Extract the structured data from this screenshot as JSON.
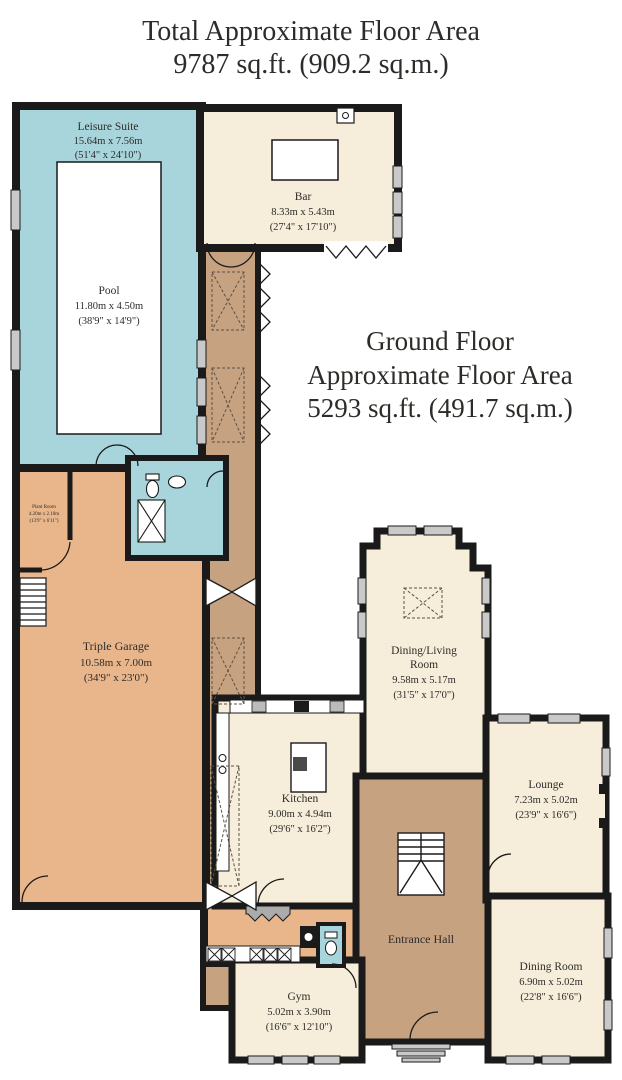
{
  "title": {
    "line1": "Total Approximate Floor Area",
    "line2": "9787 sq.ft. (909.2 sq.m.)"
  },
  "ground_floor": {
    "line1": "Ground Floor",
    "line2": "Approximate Floor Area",
    "line3": "5293 sq.ft. (491.7 sq.m.)"
  },
  "rooms": {
    "leisure_suite": {
      "name": "Leisure Suite",
      "metric": "15.64m x 7.56m",
      "imperial": "(51'4\" x 24'10\")"
    },
    "pool": {
      "name": "Pool",
      "metric": "11.80m x 4.50m",
      "imperial": "(38'9\" x 14'9\")"
    },
    "bar": {
      "name": "Bar",
      "metric": "8.33m x 5.43m",
      "imperial": "(27'4\" x 17'10\")"
    },
    "plant_room": {
      "name": "Plant Room",
      "metric": "4.20m x 2.10m",
      "imperial": "(13'9\" x 6'11\")"
    },
    "triple_garage": {
      "name": "Triple Garage",
      "metric": "10.58m x 7.00m",
      "imperial": "(34'9\" x 23'0\")"
    },
    "kitchen": {
      "name": "Kitchen",
      "metric": "9.00m x 4.94m",
      "imperial": "(29'6\" x 16'2\")"
    },
    "dining_living": {
      "name_line1": "Dining/Living",
      "name_line2": "Room",
      "metric": "9.58m x 5.17m",
      "imperial": "(31'5\" x 17'0\")"
    },
    "lounge": {
      "name": "Lounge",
      "metric": "7.23m x 5.02m",
      "imperial": "(23'9\" x 16'6\")"
    },
    "entrance_hall": {
      "name": "Entrance Hall"
    },
    "dining_room": {
      "name": "Dining Room",
      "metric": "6.90m x 5.02m",
      "imperial": "(22'8\" x 16'6\")"
    },
    "gym": {
      "name": "Gym",
      "metric": "5.02m x 3.90m",
      "imperial": "(16'6\" x 12'10\")"
    }
  },
  "colors": {
    "pool_teal": "#a7d5db",
    "room_cream": "#f6edda",
    "garage_salmon": "#e9b68c",
    "hall_tan": "#c6a280",
    "wall_black": "#1a1a1a",
    "window_gray": "#c9c9c9",
    "pool_white": "#ffffff"
  }
}
